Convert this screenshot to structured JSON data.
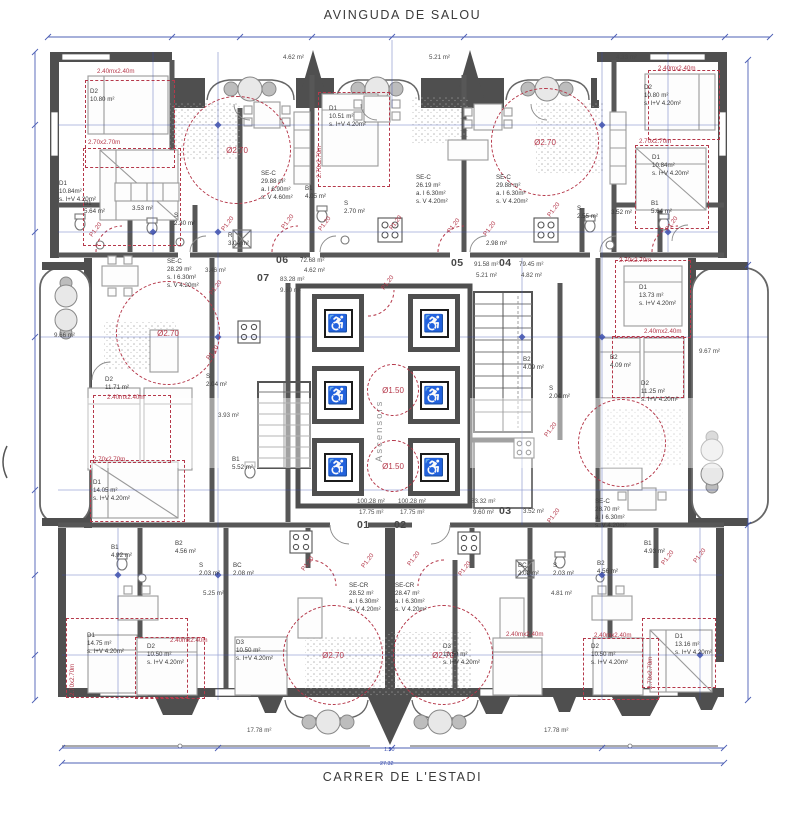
{
  "streets": {
    "top": "AVINGUDA DE SALOU",
    "bottom": "CARRER DE L'ESTADI"
  },
  "core": {
    "label": "Ascensors",
    "elevator_glyph": "♿"
  },
  "units": [
    {
      "id": "01",
      "area": "100.28 m²",
      "terrace": "17.75 m²"
    },
    {
      "id": "02",
      "area": "100.28 m²",
      "terrace": "17.75 m²"
    },
    {
      "id": "03",
      "area": "83.32 m²",
      "terrace": "9.60 m²"
    },
    {
      "id": "04",
      "area": "79.45 m²",
      "terrace": "4.82 m²"
    },
    {
      "id": "05",
      "area": "91.58 m²",
      "terrace": "5.21 m²"
    },
    {
      "id": "06",
      "area": "72.68 m²",
      "terrace": "4.62 m²"
    },
    {
      "id": "07",
      "area": "83.28 m²",
      "terrace": "9.60 m²"
    }
  ],
  "annotations": {
    "circles": [
      {
        "cx": 237,
        "cy": 150,
        "r": 54,
        "label": "Ø2.70"
      },
      {
        "cx": 545,
        "cy": 142,
        "r": 54,
        "label": "Ø2.70"
      },
      {
        "cx": 168,
        "cy": 333,
        "r": 52,
        "label": "Ø2.70"
      },
      {
        "cx": 333,
        "cy": 655,
        "r": 50,
        "label": "Ø2.70"
      },
      {
        "cx": 443,
        "cy": 655,
        "r": 50,
        "label": "Ø2.70"
      },
      {
        "cx": 622,
        "cy": 443,
        "r": 44,
        "label": ""
      },
      {
        "cx": 393,
        "cy": 390,
        "r": 26,
        "label": "Ø1.50"
      },
      {
        "cx": 393,
        "cy": 466,
        "r": 26,
        "label": "Ø1.50"
      }
    ],
    "rects": [
      {
        "x": 85,
        "y": 80,
        "w": 90,
        "h": 88
      },
      {
        "x": 83,
        "y": 148,
        "w": 98,
        "h": 98
      },
      {
        "x": 318,
        "y": 92,
        "w": 72,
        "h": 95
      },
      {
        "x": 648,
        "y": 70,
        "w": 72,
        "h": 70
      },
      {
        "x": 635,
        "y": 145,
        "w": 74,
        "h": 84
      },
      {
        "x": 615,
        "y": 260,
        "w": 76,
        "h": 78
      },
      {
        "x": 612,
        "y": 336,
        "w": 72,
        "h": 62
      },
      {
        "x": 93,
        "y": 395,
        "w": 78,
        "h": 68
      },
      {
        "x": 90,
        "y": 460,
        "w": 95,
        "h": 62
      },
      {
        "x": 66,
        "y": 618,
        "w": 122,
        "h": 80
      },
      {
        "x": 135,
        "y": 637,
        "w": 70,
        "h": 62
      },
      {
        "x": 583,
        "y": 638,
        "w": 76,
        "h": 62
      },
      {
        "x": 642,
        "y": 618,
        "w": 74,
        "h": 70
      }
    ]
  },
  "labels": [
    {
      "t": "D2\n10.80 m²",
      "x": 90,
      "y": 88
    },
    {
      "t": "D1\n10.84m²\ns. I+V 4.20m²",
      "x": 59,
      "y": 180
    },
    {
      "t": "B1\n5.64 m²",
      "x": 84,
      "y": 200
    },
    {
      "t": "3.53 m²",
      "x": 132,
      "y": 205
    },
    {
      "t": "S\n2.30 m²",
      "x": 174,
      "y": 212
    },
    {
      "t": "R\n3.04 m²",
      "x": 228,
      "y": 232
    },
    {
      "t": "SE-C\n29.88 m²\na. I 6.90m²\ns. V 4.60m²",
      "x": 261,
      "y": 170
    },
    {
      "t": "4.62 m²",
      "x": 283,
      "y": 54,
      "c": "sm"
    },
    {
      "t": "D1\n10.51 m²\ns. I+V 4.20m²",
      "x": 329,
      "y": 105
    },
    {
      "t": "SE-C\n26.19 m²\na. I 6.30m²\ns. V 4.20m²",
      "x": 416,
      "y": 174
    },
    {
      "t": "B1\n4.05 m²",
      "x": 305,
      "y": 185
    },
    {
      "t": "S\n2.70 m²",
      "x": 344,
      "y": 200
    },
    {
      "t": "5.21 m²",
      "x": 429,
      "y": 54,
      "c": "sm"
    },
    {
      "t": "4.33 m²",
      "x": 616,
      "y": 54,
      "c": "sm"
    },
    {
      "t": "SE-C\n29.88 m²\na. I 6.30m²\ns. V 4.20m²",
      "x": 496,
      "y": 174
    },
    {
      "t": "D2\n10.80 m²\ns. I+V 4.20m²",
      "x": 644,
      "y": 84
    },
    {
      "t": "D1\n10.84m²\ns. I+V 4.20m²",
      "x": 652,
      "y": 154
    },
    {
      "t": "S\n2.55 m²",
      "x": 577,
      "y": 205
    },
    {
      "t": "3.52 m²",
      "x": 611,
      "y": 209
    },
    {
      "t": "B1\n5.64 m²",
      "x": 651,
      "y": 200
    },
    {
      "t": "2.98 m²",
      "x": 486,
      "y": 240
    },
    {
      "t": "06",
      "x": 276,
      "y": 254,
      "c": "big"
    },
    {
      "t": "72.68 m²",
      "x": 300,
      "y": 257,
      "c": "sm"
    },
    {
      "t": "4.62 m²",
      "x": 304,
      "y": 267,
      "c": "sm"
    },
    {
      "t": "07",
      "x": 257,
      "y": 272,
      "c": "big"
    },
    {
      "t": "83.28 m²",
      "x": 280,
      "y": 276,
      "c": "sm"
    },
    {
      "t": "9.60 m²",
      "x": 280,
      "y": 287,
      "c": "sm"
    },
    {
      "t": "05",
      "x": 451,
      "y": 257,
      "c": "big"
    },
    {
      "t": "91.58 m²",
      "x": 474,
      "y": 261,
      "c": "sm"
    },
    {
      "t": "5.21 m²",
      "x": 476,
      "y": 272,
      "c": "sm"
    },
    {
      "t": "04",
      "x": 499,
      "y": 257,
      "c": "big"
    },
    {
      "t": "79.45 m²",
      "x": 519,
      "y": 261,
      "c": "sm"
    },
    {
      "t": "4.82 m²",
      "x": 521,
      "y": 272,
      "c": "sm"
    },
    {
      "t": "SE-C\n28.29 m²\ns. I 6.30m²\ns. V 4.20m²",
      "x": 167,
      "y": 258
    },
    {
      "t": "3.46 m²",
      "x": 205,
      "y": 267,
      "c": "sm"
    },
    {
      "t": "D2\n11.71 m²",
      "x": 105,
      "y": 376
    },
    {
      "t": "S\n2.04 m²",
      "x": 206,
      "y": 373
    },
    {
      "t": "3.93 m²",
      "x": 218,
      "y": 412,
      "c": "sm"
    },
    {
      "t": "B1\n5.52 m²",
      "x": 232,
      "y": 456
    },
    {
      "t": "D1\n14.05 m²\ns. I+V 4.20m²",
      "x": 93,
      "y": 479
    },
    {
      "t": "9.66 m²",
      "x": 54,
      "y": 332,
      "c": "sm"
    },
    {
      "t": "9.67 m²",
      "x": 699,
      "y": 348,
      "c": "sm"
    },
    {
      "t": "D1\n13.73 m²\ns. I+V 4.20m²",
      "x": 639,
      "y": 284
    },
    {
      "t": "D2\n11.25 m²\ns. I+V 4.20m²",
      "x": 641,
      "y": 380
    },
    {
      "t": "B2\n4.09 m²",
      "x": 610,
      "y": 354
    },
    {
      "t": "B2\n4.09 m²",
      "x": 523,
      "y": 356
    },
    {
      "t": "S\n2.04 m²",
      "x": 549,
      "y": 385
    },
    {
      "t": "SE-C\n28.70 m²\na. I 6.30m²\ns. V 4.20m²",
      "x": 595,
      "y": 498
    },
    {
      "t": "100.28 m²",
      "x": 357,
      "y": 498,
      "c": "sm"
    },
    {
      "t": "100.28 m²",
      "x": 398,
      "y": 498,
      "c": "sm"
    },
    {
      "t": "17.75 m²",
      "x": 359,
      "y": 509,
      "c": "sm"
    },
    {
      "t": "17.75 m²",
      "x": 400,
      "y": 509,
      "c": "sm"
    },
    {
      "t": "83.32 m²",
      "x": 471,
      "y": 498,
      "c": "sm"
    },
    {
      "t": "9.60 m²",
      "x": 473,
      "y": 509,
      "c": "sm"
    },
    {
      "t": "03",
      "x": 499,
      "y": 505,
      "c": "big"
    },
    {
      "t": "3.52 m²",
      "x": 523,
      "y": 508,
      "c": "sm"
    },
    {
      "t": "01",
      "x": 357,
      "y": 519,
      "c": "big"
    },
    {
      "t": "02",
      "x": 394,
      "y": 519,
      "c": "big"
    },
    {
      "t": "B1\n4.92 m²",
      "x": 111,
      "y": 544
    },
    {
      "t": "B2\n4.56 m²",
      "x": 175,
      "y": 540
    },
    {
      "t": "S\n2.03 m²",
      "x": 199,
      "y": 562
    },
    {
      "t": "BC\n2.08 m²",
      "x": 233,
      "y": 562
    },
    {
      "t": "5.25 m²",
      "x": 203,
      "y": 590,
      "c": "sm"
    },
    {
      "t": "SE-CR\n28.52 m²\na. I 6.30m²\ns. V 4.20m²",
      "x": 349,
      "y": 582
    },
    {
      "t": "SE-CR\n28.47 m²\na. I 6.30m²\ns. V 4.20m²",
      "x": 395,
      "y": 582
    },
    {
      "t": "4.81 m²",
      "x": 551,
      "y": 590,
      "c": "sm"
    },
    {
      "t": "BC\n2.08 m²",
      "x": 518,
      "y": 562
    },
    {
      "t": "S\n2.03 m²",
      "x": 553,
      "y": 562
    },
    {
      "t": "B2\n4.56 m²",
      "x": 597,
      "y": 560
    },
    {
      "t": "B1\n4.93 m²",
      "x": 644,
      "y": 540
    },
    {
      "t": "D1\n14.75 m²\ns. I+V 4.20m²",
      "x": 87,
      "y": 632
    },
    {
      "t": "D2\n10.50 m²\ns. I+V 4.20m²",
      "x": 147,
      "y": 643
    },
    {
      "t": "D3\n10.50 m²\ns. I+V 4.20m²",
      "x": 236,
      "y": 639
    },
    {
      "t": "D3\n10.50 m²\ns. I+V 4.20m²",
      "x": 443,
      "y": 643
    },
    {
      "t": "D2\n10.50 m²\ns. I+V 4.20m²",
      "x": 591,
      "y": 643
    },
    {
      "t": "D1\n13.16 m²\ns. I+V 4.20m²",
      "x": 675,
      "y": 633
    },
    {
      "t": "17.78 m²",
      "x": 247,
      "y": 727,
      "c": "sm"
    },
    {
      "t": "17.78 m²",
      "x": 544,
      "y": 727,
      "c": "sm"
    },
    {
      "t": "2.40mx2.40m",
      "x": 97,
      "y": 68,
      "c": "red"
    },
    {
      "t": "2.70x2.70m",
      "x": 88,
      "y": 139,
      "c": "red"
    },
    {
      "t": "2.70x2.70m",
      "x": 316,
      "y": 178,
      "c": "red rot90"
    },
    {
      "t": "2.40mx2.40m",
      "x": 658,
      "y": 65,
      "c": "red"
    },
    {
      "t": "2.70x2.70m",
      "x": 639,
      "y": 138,
      "c": "red"
    },
    {
      "t": "2.70x2.70m",
      "x": 619,
      "y": 257,
      "c": "red"
    },
    {
      "t": "2.40mx2.40m",
      "x": 644,
      "y": 328,
      "c": "red"
    },
    {
      "t": "2.40mx2.40m",
      "x": 107,
      "y": 394,
      "c": "red"
    },
    {
      "t": "2.70x2.70m",
      "x": 93,
      "y": 456,
      "c": "red"
    },
    {
      "t": "2.70x2.70m",
      "x": 69,
      "y": 696,
      "c": "red rot90"
    },
    {
      "t": "2.40mx2.40m",
      "x": 170,
      "y": 637,
      "c": "red"
    },
    {
      "t": "2.40mx2.40m",
      "x": 506,
      "y": 631,
      "c": "red"
    },
    {
      "t": "2.40mx2.40m",
      "x": 594,
      "y": 632,
      "c": "red"
    },
    {
      "t": "2.70x2.70m",
      "x": 647,
      "y": 689,
      "c": "red rot90"
    },
    {
      "t": "P1.20",
      "x": 88,
      "y": 234,
      "c": "red rot45"
    },
    {
      "t": "P1.20",
      "x": 220,
      "y": 228,
      "c": "red rot45"
    },
    {
      "t": "P1.20",
      "x": 280,
      "y": 226,
      "c": "red rot45"
    },
    {
      "t": "P1.20",
      "x": 317,
      "y": 228,
      "c": "red rot45"
    },
    {
      "t": "P1.20",
      "x": 388,
      "y": 227,
      "c": "red rot45"
    },
    {
      "t": "P1.20",
      "x": 446,
      "y": 230,
      "c": "red rot45"
    },
    {
      "t": "P1.20",
      "x": 482,
      "y": 233,
      "c": "red rot45"
    },
    {
      "t": "P1.20",
      "x": 546,
      "y": 214,
      "c": "red rot45"
    },
    {
      "t": "P1.20",
      "x": 664,
      "y": 228,
      "c": "red rot45"
    },
    {
      "t": "P1.20",
      "x": 380,
      "y": 287,
      "c": "red rot45"
    },
    {
      "t": "P1.20",
      "x": 208,
      "y": 292,
      "c": "red rot45"
    },
    {
      "t": "P1.20",
      "x": 205,
      "y": 357,
      "c": "red rot45"
    },
    {
      "t": "P1.20",
      "x": 300,
      "y": 568,
      "c": "red rot45"
    },
    {
      "t": "P1.20",
      "x": 360,
      "y": 565,
      "c": "red rot45"
    },
    {
      "t": "P1.20",
      "x": 406,
      "y": 563,
      "c": "red rot45"
    },
    {
      "t": "P1.20",
      "x": 457,
      "y": 573,
      "c": "red rot45"
    },
    {
      "t": "P1.20",
      "x": 660,
      "y": 562,
      "c": "red rot45"
    },
    {
      "t": "P1.20",
      "x": 692,
      "y": 560,
      "c": "red rot45"
    },
    {
      "t": "P1.20",
      "x": 543,
      "y": 434,
      "c": "red rot45"
    },
    {
      "t": "P1.20",
      "x": 546,
      "y": 520,
      "c": "red rot45"
    },
    {
      "t": "1.50",
      "x": 384,
      "y": 747,
      "c": "blue"
    },
    {
      "t": "27.32",
      "x": 380,
      "y": 761,
      "c": "blue"
    }
  ]
}
